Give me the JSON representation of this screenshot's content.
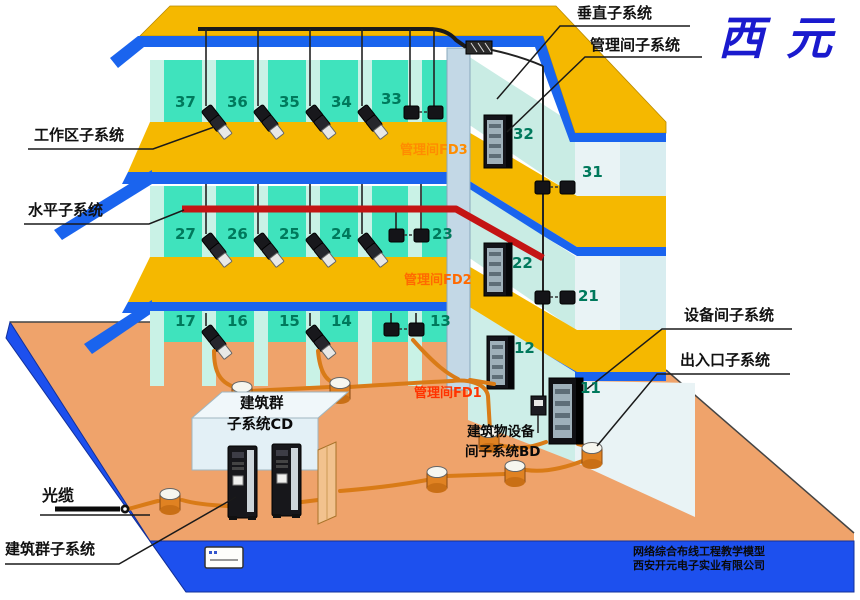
{
  "brand": {
    "logo_text": "西元",
    "logo_color": "#1a1ace"
  },
  "callouts": {
    "vertical": "垂直子系统",
    "management_room": "管理间子系统",
    "work_area": "工作区子系统",
    "horizontal": "水平子系统",
    "equipment_room": "设备间子系统",
    "entrance": "出入口子系统",
    "fiber_cable": "光缆",
    "campus": "建筑群子系统"
  },
  "floors": [
    {
      "fd_label": "管理间FD3",
      "fd_color": "#ff8c00",
      "rooms": [
        "37",
        "36",
        "35",
        "34",
        "33"
      ],
      "riser_room": "32",
      "wing_room": "31"
    },
    {
      "fd_label": "管理间FD2",
      "fd_color": "#ff6a00",
      "rooms": [
        "27",
        "26",
        "25",
        "24",
        "23"
      ],
      "riser_room": "22",
      "wing_room": "21"
    },
    {
      "fd_label": "管理间FD1",
      "fd_color": "#ff3300",
      "rooms": [
        "17",
        "16",
        "15",
        "14",
        "13"
      ],
      "riser_room": "12",
      "wing_room": "11"
    }
  ],
  "campus_box": {
    "line1": "建筑群",
    "line2": "子系统CD"
  },
  "equipment_box": {
    "line1": "建筑物设备",
    "line2": "间子系统BD"
  },
  "footer": {
    "line1": "网络综合布线工程教学模型",
    "line2": "西安开元电子实业有限公司"
  },
  "icons": {
    "rack": "distribution-cabinet",
    "phone_device": "work-area-terminal",
    "outlet_pair": "network-outlet-pair",
    "manhole": "cable-manhole",
    "server_tower": "campus-server",
    "fiber_dot": "optical-cable-end",
    "door_panel": "entrance-door"
  },
  "colors": {
    "roof": "#f5b800",
    "wall": "#3fe3bd",
    "slab_edge": "#1a64ee",
    "ground": "#efa36b",
    "base": "#1d50ee",
    "horizontal_cable": "#c41414",
    "conduit": "#d97b17",
    "room_number": "#00795c"
  }
}
